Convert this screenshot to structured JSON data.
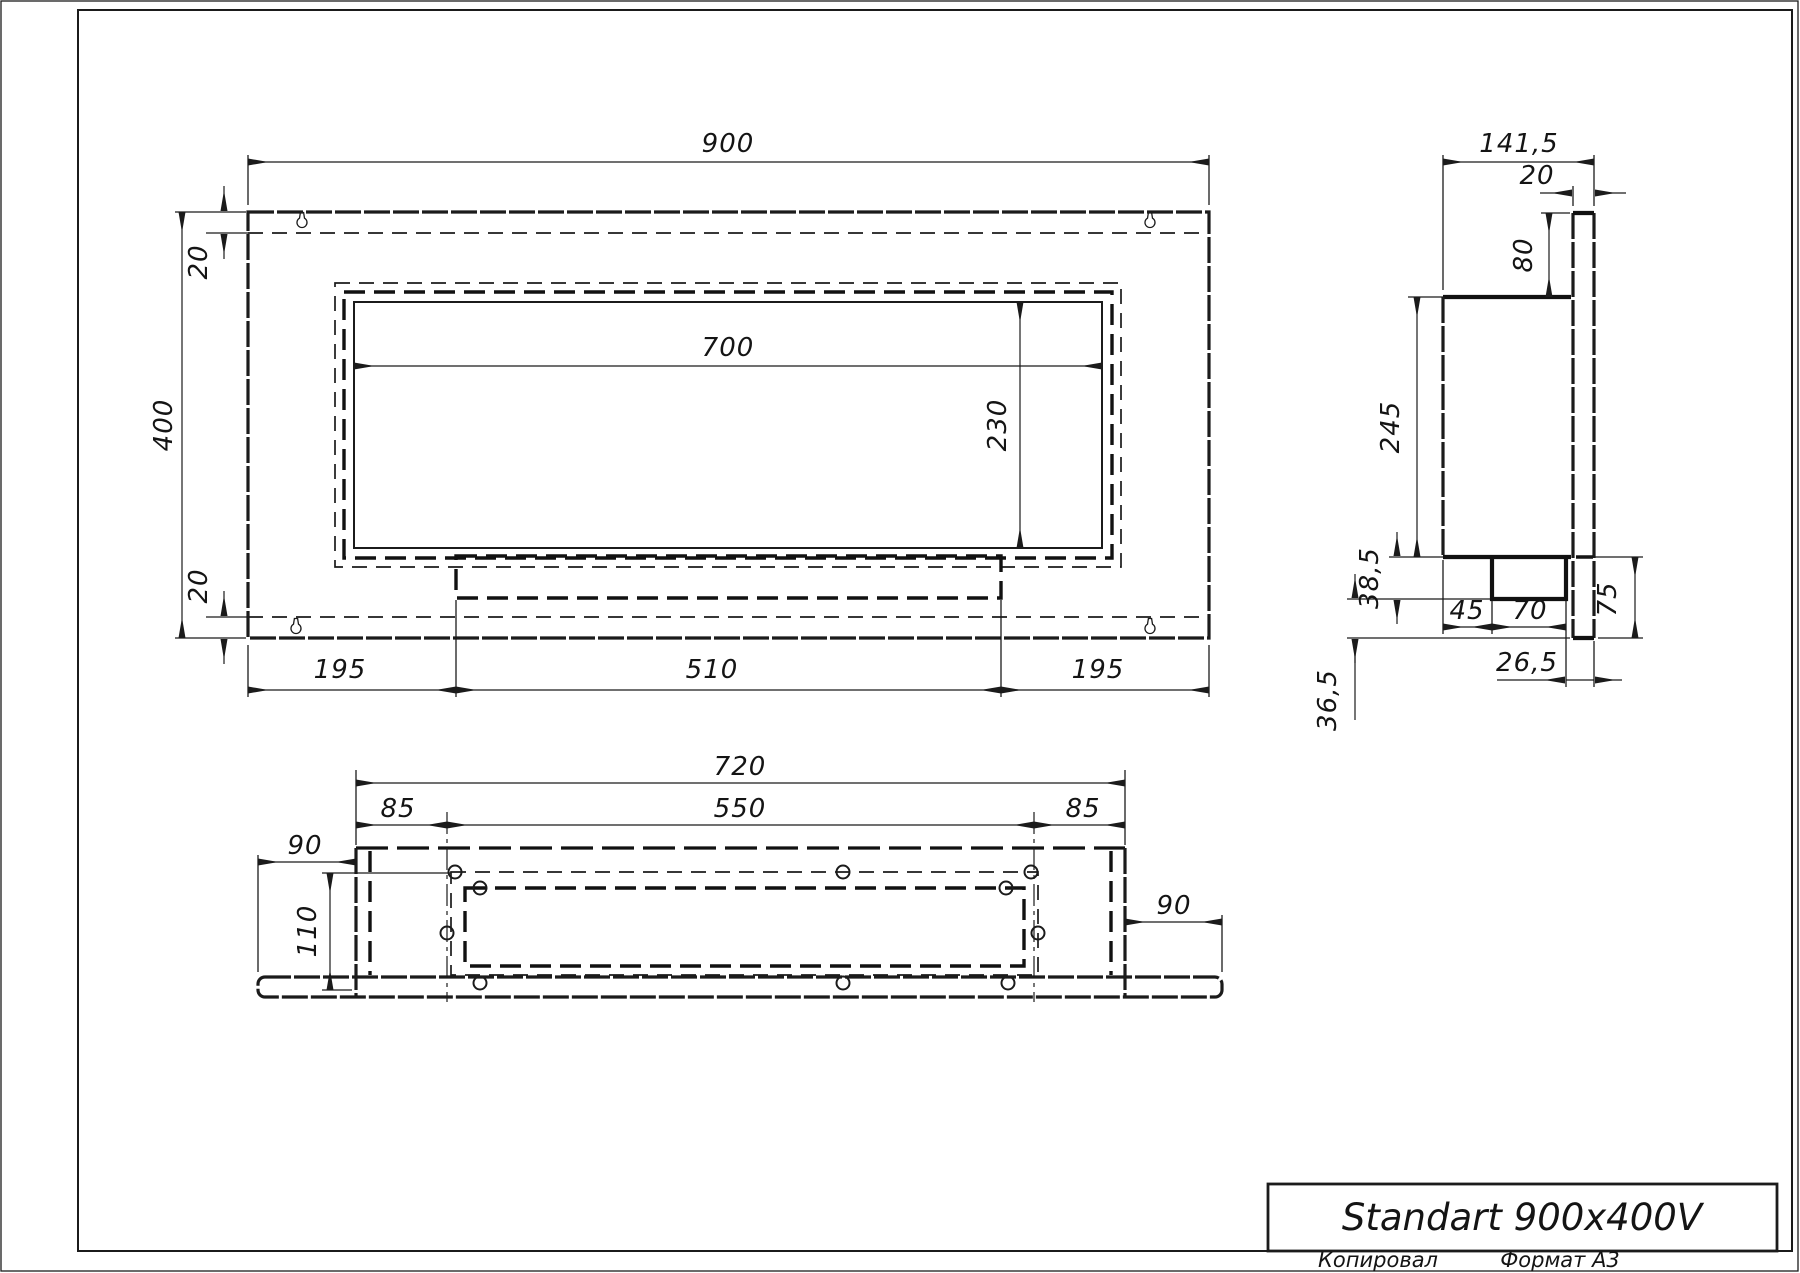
{
  "front_view": {
    "dims": {
      "overall_width": "900",
      "overall_height": "400",
      "top_flange": "20",
      "bottom_flange": "20",
      "opening_width": "700",
      "opening_height": "230",
      "bottom_left": "195",
      "bottom_center": "510",
      "bottom_right": "195"
    }
  },
  "side_view": {
    "dims": {
      "overall_depth": "141,5",
      "plate_thickness": "20",
      "plate_top_offset": "80",
      "body_height": "245",
      "burner_drop": "38,5",
      "lower_gap": "36,5",
      "burner_front_offset": "45",
      "burner_depth": "70",
      "lower_height": "75",
      "back_offset": "26,5"
    }
  },
  "bottom_view": {
    "dims": {
      "box_width": "720",
      "cutout_width": "550",
      "left_inset": "85",
      "right_inset": "85",
      "left_overhang": "90",
      "right_overhang": "90",
      "inner_depth": "110"
    }
  },
  "title_block": {
    "title": "Standart 900x400V",
    "footer_left": "Копировал",
    "footer_right": "Формат A3"
  }
}
